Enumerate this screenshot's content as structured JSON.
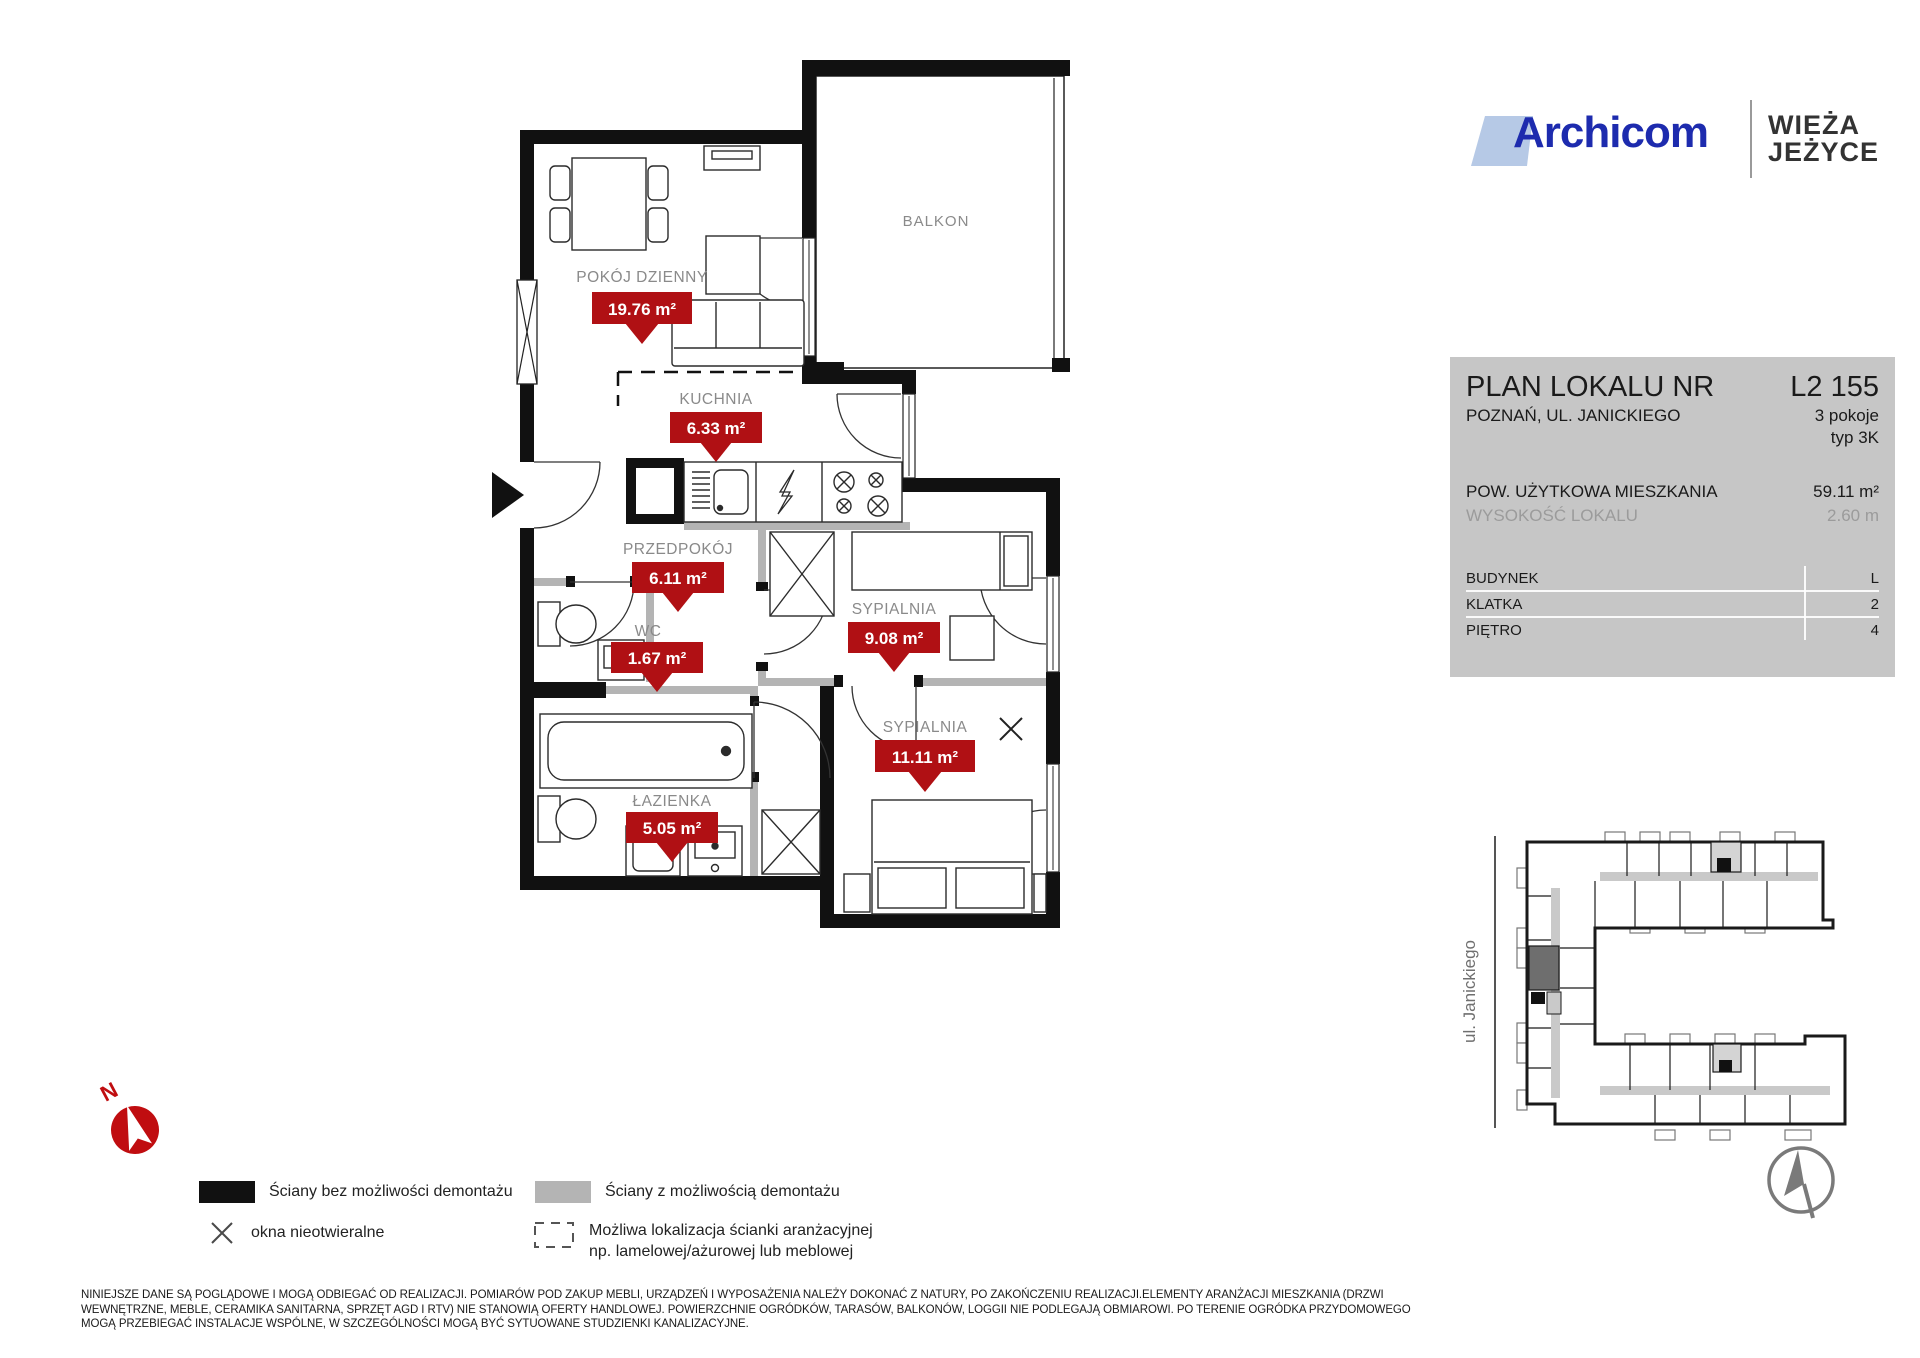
{
  "header": {
    "brand": "Archicom",
    "project_line1": "WIEŻA",
    "project_line2": "JEŻYCE"
  },
  "info_panel": {
    "title": "PLAN LOKALU NR",
    "unit_number": "L2 155",
    "address": "POZNAŃ, UL. JANICKIEGO",
    "rooms_count": "3 pokoje",
    "unit_type": "typ 3K",
    "area_label": "POW. UŻYTKOWA MIESZKANIA",
    "area_value": "59.11 m²",
    "height_label": "WYSOKOŚĆ LOKALU",
    "height_value": "2.60 m",
    "table": [
      {
        "label": "BUDYNEK",
        "value": "L"
      },
      {
        "label": "KLATKA",
        "value": "2"
      },
      {
        "label": "PIĘTRO",
        "value": "4"
      }
    ]
  },
  "floor_plan": {
    "balcony_label": "BALKON",
    "north_letter": "N",
    "rooms": [
      {
        "name": "POKÓJ DZIENNY",
        "area": "19.76 m²"
      },
      {
        "name": "KUCHNIA",
        "area": "6.33 m²"
      },
      {
        "name": "PRZEDPOKÓJ",
        "area": "6.11 m²"
      },
      {
        "name": "WC",
        "area": "1.67 m²"
      },
      {
        "name": "SYPIALNIA",
        "area": "9.08 m²"
      },
      {
        "name": "ŁAZIENKA",
        "area": "5.05 m²"
      },
      {
        "name": "SYPIALNIA",
        "area": "11.11 m²"
      }
    ]
  },
  "site_map": {
    "street_label": "ul. Janickiego"
  },
  "legend": {
    "walls_fixed": "Ściany bez możliwości demontażu",
    "walls_removable": "Ściany z możliwością demontażu",
    "windows_fixed": "okna nieotwieralne",
    "partition_line1": "Możliwa lokalizacja ścianki aranżacyjnej",
    "partition_line2": "np. lamelowej/ażurowej lub meblowej"
  },
  "disclaimer": "NINIEJSZE DANE SĄ POGLĄDOWE I MOGĄ ODBIEGAĆ OD REALIZACJI. POMIARÓW POD ZAKUP MEBLI, URZĄDZEŃ I WYPOSAŻENIA NALEŻY DOKONAĆ Z NATURY, PO ZAKOŃCZENIU REALIZACJI.ELEMENTY ARANŻACJI MIESZKANIA (DRZWI WEWNĘTRZNE, MEBLE, CERAMIKA SANITARNA, SPRZĘT AGD I RTV) NIE STANOWIĄ OFERTY HANDLOWEJ. POWIERZCHNIE OGRÓDKÓW, TARASÓW, BALKONÓW, LOGGII NIE PODLEGAJĄ OBMIAROWI. PO TERENIE OGRÓDKA PRZYDOMOWEGO MOGĄ PRZEBIEGAĆ INSTALACJE WSPÓLNE,  W SZCZEGÓLNOŚCI MOGĄ BYĆ SYTUOWANE STUDZIENKI KANALIZACYJNE.",
  "colors": {
    "tag_red": "#b01014",
    "wall_black": "#111111",
    "wall_gray": "#b4b4b4",
    "brand_blue": "#1d2bae",
    "brand_lightblue": "#b6c9e6",
    "compass_red": "#c00d10",
    "panel_gray": "#c6c6c6"
  }
}
